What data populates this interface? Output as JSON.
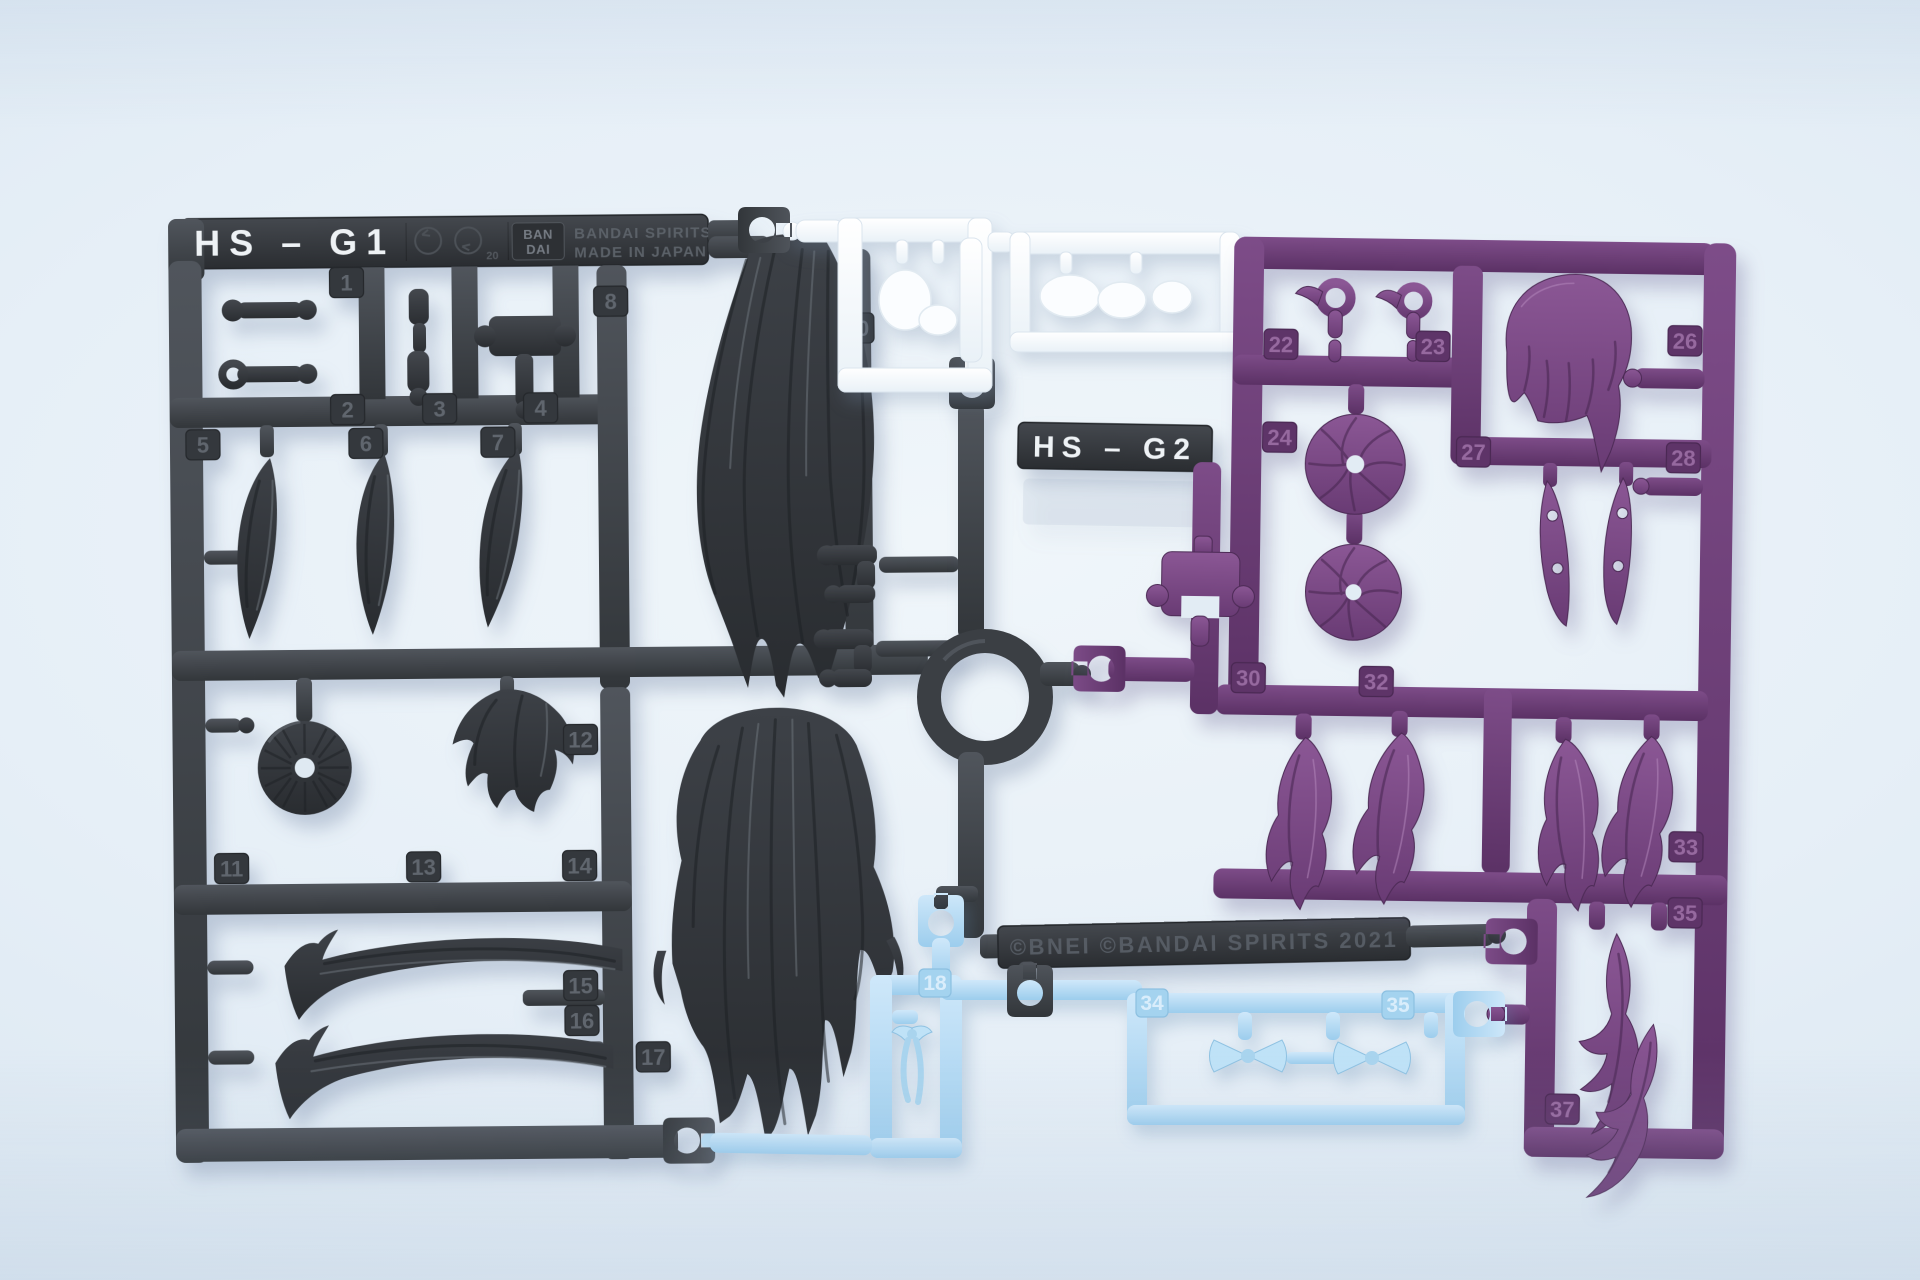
{
  "photo": {
    "subject": "Plastic model kit hair-part runners (sprues) for an anime figure kit, photographed on a pale blue-white surface",
    "background_color": "#e3edf5"
  },
  "plates": {
    "g1_label": "HS – G1",
    "g2_label": "HS – G2",
    "logo_top": "BAN",
    "logo_bottom": "DAI",
    "stamp_line1": "BANDAI SPIRITS",
    "stamp_line2": "MADE IN JAPAN 2024",
    "material_mark_note": "20",
    "copyright": "©BNEI ©BANDAI SPIRITS 2021"
  },
  "runners": {
    "g1": {
      "name": "dark gray runner HS-G1 (long black hair parts, bun, bangs, joints)",
      "plastic_color": "#3c4045",
      "part_numbers": [
        "1",
        "2",
        "3",
        "4",
        "5",
        "6",
        "7",
        "8",
        "10",
        "11",
        "12",
        "13",
        "14",
        "15",
        "16",
        "17"
      ]
    },
    "g2": {
      "name": "purple runner HS-G2 (bob hair, swirl buns, wavy locks)",
      "plastic_color": "#6e4078",
      "part_numbers": [
        "22",
        "23",
        "24",
        "26",
        "27",
        "28",
        "30",
        "32",
        "33",
        "35",
        "37"
      ]
    },
    "white": {
      "name": "white runner (face parts)",
      "plastic_color": "#f6fafd",
      "part_numbers": []
    },
    "blue": {
      "name": "clear light blue runner (ribbon and bow parts)",
      "plastic_color": "#aedaf4",
      "part_numbers": [
        "18",
        "34",
        "35"
      ]
    }
  }
}
